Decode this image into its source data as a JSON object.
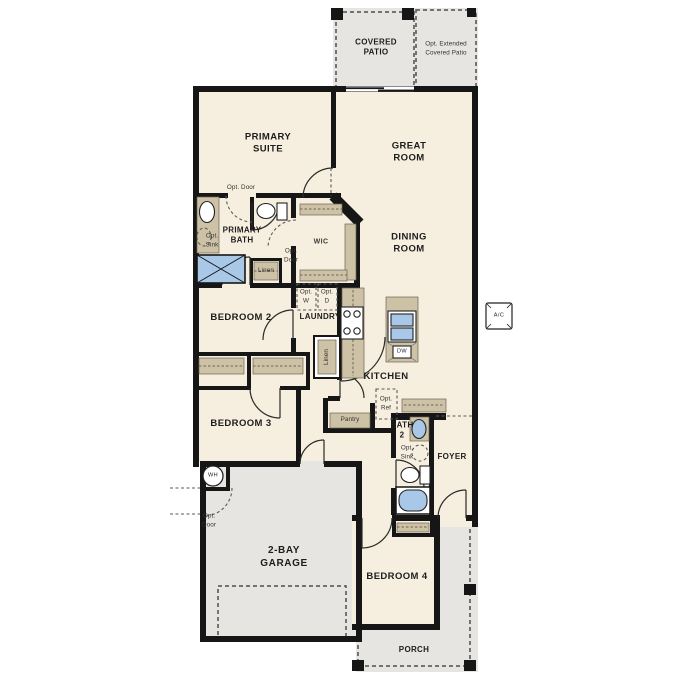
{
  "plan_title": "single-story floor plan",
  "colors": {
    "interior_cream": "#f6efdf",
    "exterior_gray": "#e6e5e1",
    "cabinet_tan": "#cec2a6",
    "fixture_blue": "#a9c7e6",
    "wall_black": "#161616"
  },
  "labels": {
    "covered_patio": "COVERED\nPATIO",
    "opt_extended_patio": "Opt. Extended\nCovered Patio",
    "primary_suite": "PRIMARY\nSUITE",
    "great_room": "GREAT\nROOM",
    "dining_room": "DINING\nROOM",
    "primary_bath": "PRIMARY\nBATH",
    "wic": "WIC",
    "bedroom_2": "BEDROOM 2",
    "bedroom_3": "BEDROOM 3",
    "bedroom_4": "BEDROOM 4",
    "laundry": "LAUNDRY",
    "kitchen": "KITCHEN",
    "pantry": "Pantry",
    "bath_2": "BATH\n2",
    "foyer": "FOYER",
    "garage": "2-BAY\nGARAGE",
    "porch": "PORCH",
    "opt_door": "Opt. Door",
    "opt_door_2l": "Opt.\nDoor",
    "opt_sink": "Opt.\nSink",
    "opt_w": "Opt.\nW",
    "opt_d": "Opt.\nD",
    "opt_ref": "Opt.\nRef",
    "linen": "Linen",
    "dw": "DW",
    "wh": "WH",
    "ac": "A/C"
  }
}
